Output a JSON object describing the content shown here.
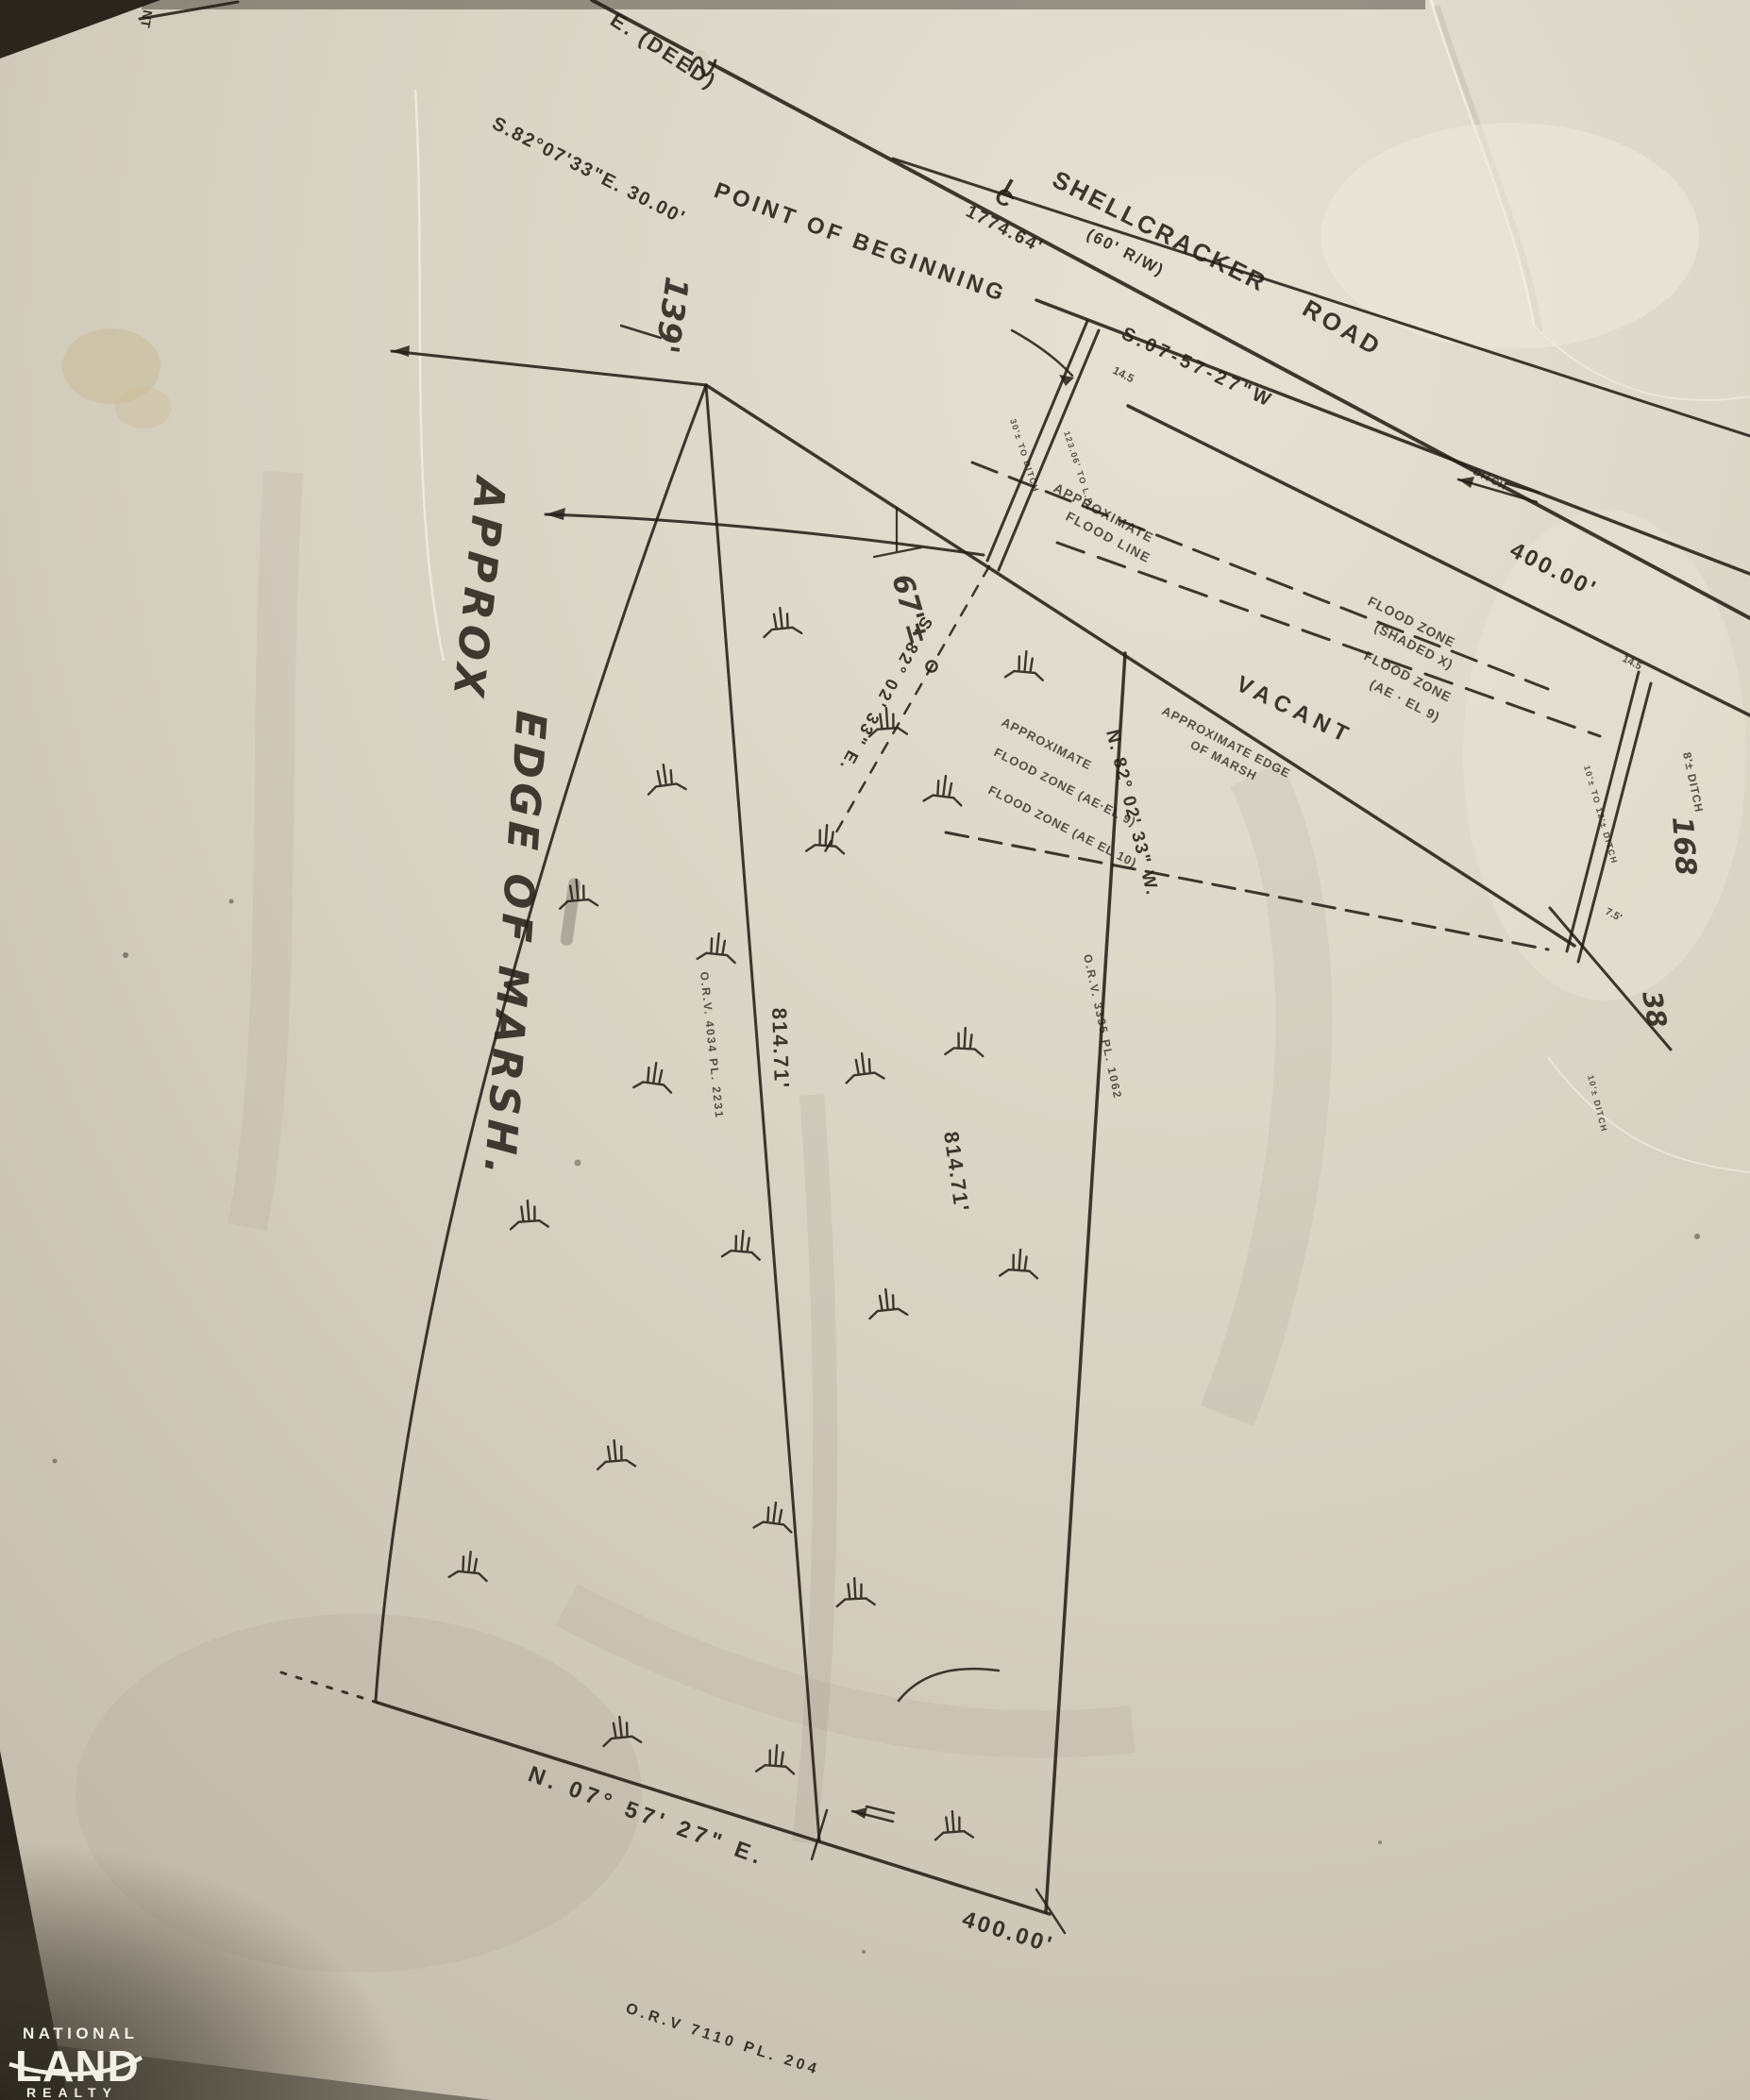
{
  "colors": {
    "paper": "#d7d1c2",
    "ink": "#241f17",
    "logo_white": "#f2efe7",
    "edge_shadow": "#2e2a22",
    "stain": "#c8b98e"
  },
  "road": {
    "deed_label": "E. (DEED)",
    "bearing_deed": "S.82°07'33\"E. 30.00'",
    "centerline_c": "C",
    "centerline_l": "L",
    "name_1": "SHELLCRACKER",
    "name_2": "ROAD",
    "row": "(60' R/W)",
    "distance": "1774.64'",
    "bearing_sw": "S.07-57-27\"W",
    "frontage": "400.00'",
    "ditch": "DITCH",
    "fragment": "NT"
  },
  "pob": {
    "label": "POINT OF BEGINNING",
    "dim_a": "14.5",
    "dim_b": "14.5",
    "note_left": "30'± TO DITCH",
    "note_right": "123.06' TO L.P."
  },
  "hand": {
    "dim_139": "139'",
    "dim_67": "67'±",
    "tie_bearing": "S. 82° 02' 33\" E.",
    "marsh_1": "APPROX",
    "marsh_2": "EDGE OF MARSH.",
    "dim_168": "168",
    "dim_38": "38",
    "dim_75": "7.5'"
  },
  "flood": {
    "line_1": "APPROXIMATE",
    "line_2": "FLOOD LINE",
    "shaded_1": "FLOOD ZONE",
    "shaded_2": "(SHADED X)",
    "ae9_1": "FLOOD ZONE",
    "ae9_2": "(AE · EL 9)",
    "mid_1": "APPROXIMATE",
    "mid_2": "FLOOD ZONE (AE·EL 9)",
    "mid_3": "FLOOD ZONE (AE EL 10)",
    "marsh_1": "APPROXIMATE EDGE",
    "marsh_2": "OF MARSH"
  },
  "parcel": {
    "vacant": "VACANT",
    "west_dist": "814.71'",
    "east_dist": "814.71'",
    "east_bearing": "N. 82° 02' 33\" W.",
    "south_bearing": "N. 07° 57' 27\" E.",
    "south_dist": "400.00'",
    "orv_west": "O.R.V. 4034 PL. 2231",
    "orv_east": "O.R.V. 3335 PL. 1062",
    "orv_south": "O.R.V 7110 PL. 204",
    "ditch_note": "8'± DITCH",
    "ditch_width": "10'± TO 12'± DITCH",
    "ditch_small": "10'± DITCH"
  },
  "logo": {
    "line1": "NATIONAL",
    "line2": "LAND",
    "line3": "REALTY"
  }
}
